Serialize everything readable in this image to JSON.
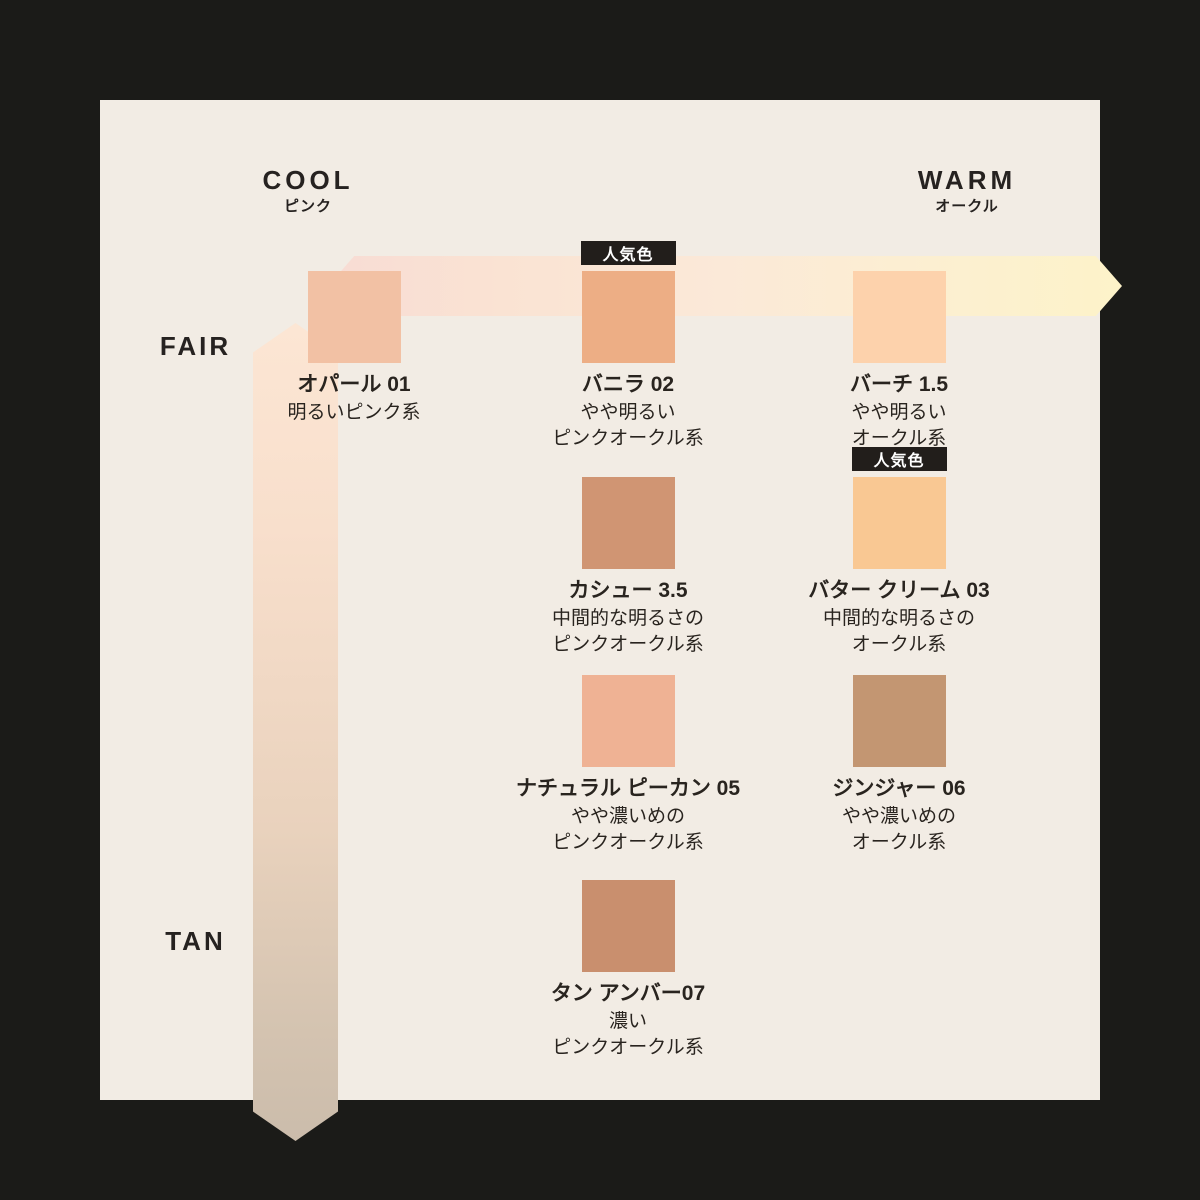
{
  "frame": {
    "background": "#1b1b18",
    "panel_background": "#f2ece4"
  },
  "temperature_axis": {
    "cool_label": "COOL",
    "cool_sub": "ピンク",
    "warm_label": "WARM",
    "warm_sub": "オークル",
    "gradient": [
      "#f8dcd4",
      "#fbe9d8",
      "#fdf3c9"
    ]
  },
  "depth_axis": {
    "fair_label": "FAIR",
    "tan_label": "TAN",
    "gradient": [
      "#fce6d4",
      "#cbbcab"
    ]
  },
  "popular_badge_label": "人気色",
  "badge_colors": {
    "background": "#221e1b",
    "text": "#ffffff"
  },
  "shades": [
    {
      "name": "オパール 01",
      "description": "明るいピンク系",
      "color": "#f2c1a4",
      "popular": false,
      "column": 1,
      "row": 1
    },
    {
      "name": "バニラ 02",
      "description": "やや明るい\nピンクオークル系",
      "color": "#edae85",
      "popular": true,
      "column": 2,
      "row": 1
    },
    {
      "name": "バーチ 1.5",
      "description": "やや明るい\nオークル系",
      "color": "#fdd2ac",
      "popular": false,
      "column": 3,
      "row": 1
    },
    {
      "name": "カシュー 3.5",
      "description": "中間的な明るさの\nピンクオークル系",
      "color": "#d09573",
      "popular": false,
      "column": 2,
      "row": 2
    },
    {
      "name": "バター クリーム 03",
      "description": "中間的な明るさの\nオークル系",
      "color": "#f9c893",
      "popular": true,
      "column": 3,
      "row": 2
    },
    {
      "name": "ナチュラル ピーカン 05",
      "description": "やや濃いめの\nピンクオークル系",
      "color": "#efb294",
      "popular": false,
      "column": 2,
      "row": 3
    },
    {
      "name": "ジンジャー 06",
      "description": "やや濃いめの\nオークル系",
      "color": "#c39672",
      "popular": false,
      "column": 3,
      "row": 3
    },
    {
      "name": "タン アンバー07",
      "description": "濃い\nピンクオークル系",
      "color": "#c98f6e",
      "popular": false,
      "column": 2,
      "row": 4
    }
  ]
}
